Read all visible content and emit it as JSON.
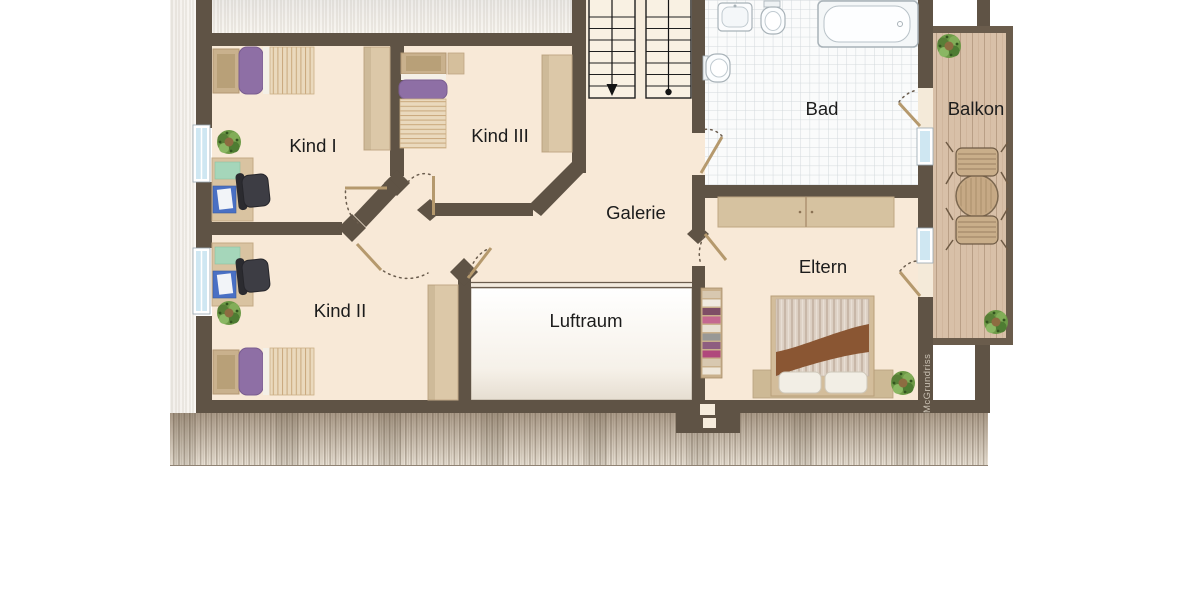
{
  "palette": {
    "wall": "#5f5345",
    "floor": "#f8e9d7",
    "tile_floor": "#fafbfb",
    "balcony_wood": "#d8c0a8",
    "accent_purple": "#8e6fa5",
    "label_color": "#1c1c1c"
  },
  "rooms": {
    "kind1": "Kind I",
    "kind3": "Kind III",
    "kind2": "Kind II",
    "galerie": "Galerie",
    "luftraum": "Luftraum",
    "bad": "Bad",
    "balkon": "Balkon",
    "eltern": "Eltern"
  },
  "watermark": "McGrundriss"
}
